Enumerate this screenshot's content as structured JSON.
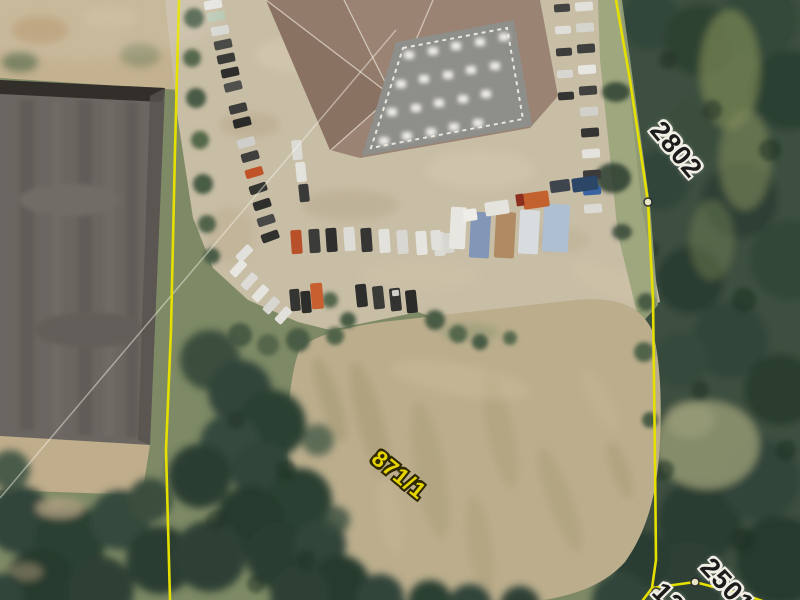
{
  "map": {
    "parcel_labels": {
      "east": {
        "text": "2802"
      },
      "meadow": {
        "text": "871/1"
      },
      "southeast": {
        "text": "2501"
      },
      "south_partial": {
        "text": "12"
      }
    },
    "colors": {
      "boundary_line": "#e5e000",
      "meadow_label_fill": "#e6d400",
      "number_label_fill": "#1c1c1c",
      "label_halo": "#f2efe6"
    }
  }
}
